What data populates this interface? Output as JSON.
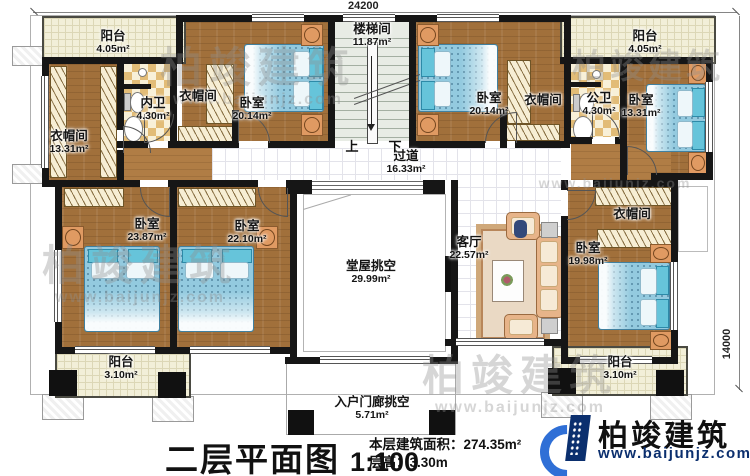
{
  "plan": {
    "name": "二层平面图",
    "scale": "1:100",
    "stats": {
      "area_label": "本层建筑面积：",
      "area_value": "274.35m²",
      "height_label": "层高：",
      "height_value": "3.30m"
    },
    "dimensions": {
      "width": "24200",
      "height": "14000"
    },
    "stair": {
      "up": "上",
      "down": "下"
    }
  },
  "rooms": {
    "balcony_tl": {
      "name": "阳台",
      "area": "4.05m²"
    },
    "balcony_tr": {
      "name": "阳台",
      "area": "4.05m²"
    },
    "cloak_left": {
      "name": "衣帽间",
      "area": "13.31m²"
    },
    "bath_inner": {
      "name": "内卫",
      "area": "4.30m²"
    },
    "cloak_top1": {
      "name": "衣帽间"
    },
    "bed_tl": {
      "name": "卧室",
      "area": "20.14m²"
    },
    "stairwell": {
      "name": "楼梯间",
      "area": "11.87m²"
    },
    "bed_tr": {
      "name": "卧室",
      "area": "20.14m²"
    },
    "cloak_top2": {
      "name": "衣帽间"
    },
    "bath_public": {
      "name": "公卫",
      "area": "4.30m²"
    },
    "bed_right": {
      "name": "卧室",
      "area": "13.31m²"
    },
    "corridor": {
      "name": "过道",
      "area": "16.33m²"
    },
    "bed_ml": {
      "name": "卧室",
      "area": "23.87m²"
    },
    "bed_mc": {
      "name": "卧室",
      "area": "22.10m²"
    },
    "hall_void": {
      "name": "堂屋挑空",
      "area": "29.99m²"
    },
    "living": {
      "name": "客厅",
      "area": "22.57m²"
    },
    "cloak_right": {
      "name": "衣帽间"
    },
    "bed_br": {
      "name": "卧室",
      "area": "19.98m²"
    },
    "balcony_bl": {
      "name": "阳台",
      "area": "3.10m²"
    },
    "balcony_br": {
      "name": "阳台",
      "area": "3.10m²"
    },
    "porch_void": {
      "name": "入户门廊挑空",
      "area": "5.71m²"
    }
  },
  "branding": {
    "company": "柏竣建筑",
    "website": "www.baijunjz.com"
  },
  "watermark": {
    "company": "柏竣建筑",
    "website": "www.baijunjz.com"
  },
  "colors": {
    "wall": "#161616",
    "wood_floor": "#a1703b",
    "bed": "#93cadf",
    "balcony": "#f2efd8",
    "bath_checker": "#e2bc77",
    "logo_blue": "#2f6fd6",
    "logo_navy": "#0b2f6e"
  }
}
